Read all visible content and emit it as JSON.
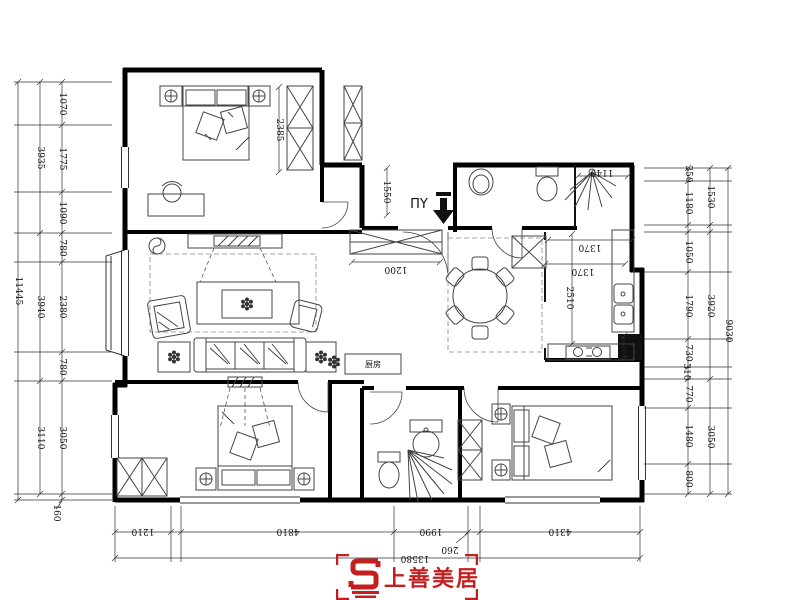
{
  "logo": {
    "brand": "上善美居",
    "color": "#c41f1f"
  },
  "dim_labels": [
    {
      "t": "1070",
      "x": 60,
      "y": 104,
      "r": 90
    },
    {
      "t": "1775",
      "x": 60,
      "y": 159,
      "r": 90
    },
    {
      "t": "1090",
      "x": 60,
      "y": 213,
      "r": 90
    },
    {
      "t": "780",
      "x": 60,
      "y": 248,
      "r": 90
    },
    {
      "t": "2380",
      "x": 60,
      "y": 307,
      "r": 90
    },
    {
      "t": "780",
      "x": 60,
      "y": 367,
      "r": 90
    },
    {
      "t": "3050",
      "x": 60,
      "y": 438,
      "r": 90
    },
    {
      "t": "160",
      "x": 54,
      "y": 513,
      "r": 90
    },
    {
      "t": "3935",
      "x": 38,
      "y": 158,
      "r": 90
    },
    {
      "t": "3940",
      "x": 38,
      "y": 307,
      "r": 90
    },
    {
      "t": "3110",
      "x": 38,
      "y": 438,
      "r": 90
    },
    {
      "t": "11445",
      "x": 16,
      "y": 291,
      "r": 90
    },
    {
      "t": "350",
      "x": 686,
      "y": 174,
      "r": 90
    },
    {
      "t": "1180",
      "x": 686,
      "y": 203,
      "r": 90
    },
    {
      "t": "1050",
      "x": 686,
      "y": 252,
      "r": 90
    },
    {
      "t": "1790",
      "x": 686,
      "y": 306,
      "r": 90
    },
    {
      "t": "730",
      "x": 686,
      "y": 353,
      "r": 90
    },
    {
      "t": "310",
      "x": 684,
      "y": 372,
      "r": 90
    },
    {
      "t": "770",
      "x": 686,
      "y": 394,
      "r": 90
    },
    {
      "t": "1480",
      "x": 686,
      "y": 436,
      "r": 90
    },
    {
      "t": "800",
      "x": 686,
      "y": 479,
      "r": 90
    },
    {
      "t": "1530",
      "x": 708,
      "y": 197,
      "r": 90
    },
    {
      "t": "3920",
      "x": 708,
      "y": 306,
      "r": 90
    },
    {
      "t": "3050",
      "x": 708,
      "y": 437,
      "r": 90
    },
    {
      "t": "9030",
      "x": 726,
      "y": 331,
      "r": 90
    },
    {
      "t": "1210",
      "x": 143,
      "y": 529,
      "r": 180
    },
    {
      "t": "4810",
      "x": 288,
      "y": 529,
      "r": 180
    },
    {
      "t": "1990",
      "x": 431,
      "y": 529,
      "r": 180
    },
    {
      "t": "260",
      "x": 450,
      "y": 547,
      "r": 180
    },
    {
      "t": "4310",
      "x": 560,
      "y": 529,
      "r": 180
    },
    {
      "t": "13580",
      "x": 415,
      "y": 556,
      "r": 180
    },
    {
      "t": "2385",
      "x": 277,
      "y": 130,
      "r": 90
    },
    {
      "t": "1550",
      "x": 384,
      "y": 192,
      "r": 90
    },
    {
      "t": "1200",
      "x": 396,
      "y": 267,
      "r": 180
    },
    {
      "t": "1140",
      "x": 602,
      "y": 170,
      "r": 180
    },
    {
      "t": "1370",
      "x": 590,
      "y": 245,
      "r": 180
    },
    {
      "t": "1370",
      "x": 583,
      "y": 269,
      "r": 180
    },
    {
      "t": "2510",
      "x": 567,
      "y": 298,
      "r": 90
    },
    {
      "t": "730",
      "x": 619,
      "y": 346,
      "r": 90
    },
    {
      "t": "ΠY",
      "x": 419,
      "y": 208,
      "r": 0,
      "cls": "entry",
      "n": "entry-label"
    },
    {
      "t": "厨房",
      "x": 373,
      "y": 367,
      "r": 0,
      "cls": "kbox",
      "n": "kitchen-box-label"
    }
  ]
}
